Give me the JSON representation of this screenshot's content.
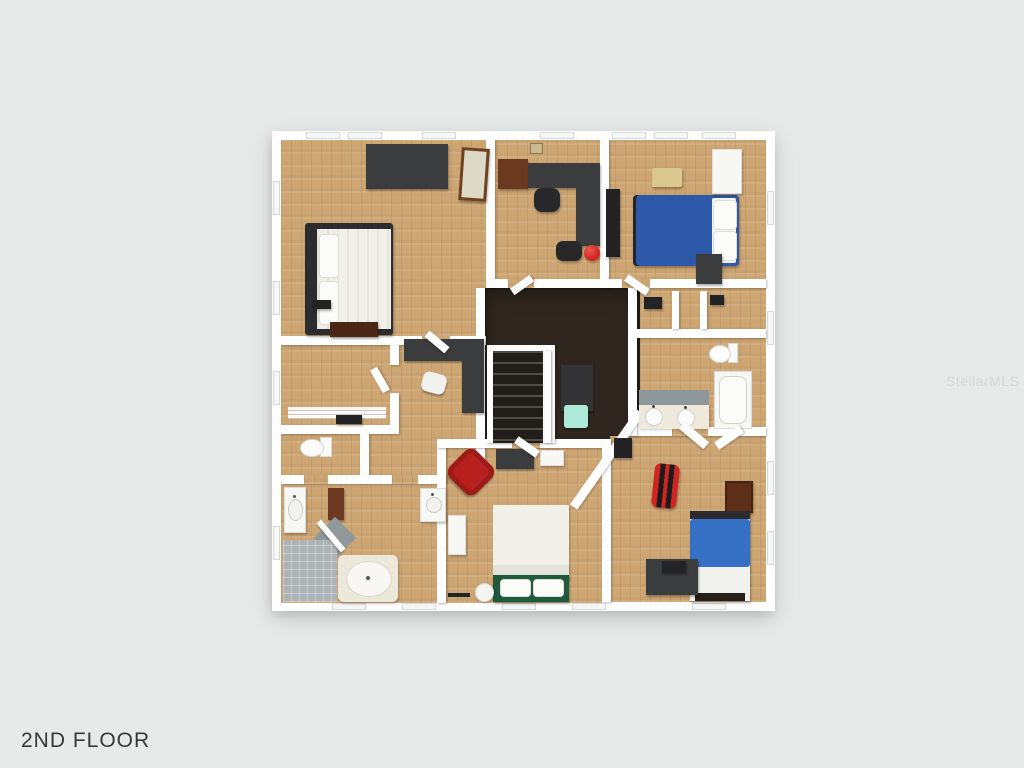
{
  "label": {
    "title": "2ND FLOOR"
  },
  "watermark": {
    "text": "StellarMLS"
  },
  "colors": {
    "bg": "#e8eaea",
    "wall": "#fefefe",
    "wood": "#cda673",
    "carpet": "#2f271f",
    "tile-gray": "#aeb4b6",
    "mat-gray": "#8f989a",
    "counter-cream": "#efe9dc",
    "bed-blue": "#2e59a8",
    "bed-blue-bright": "#3570c4",
    "linen-white": "#f0efe8",
    "chair-red": "#b7201d",
    "ball-red": "#cf2621",
    "gamer-red": "#d02420",
    "headboard-green": "#1e5a3b",
    "bench-tan": "#dbc890",
    "table-teal": "#aeead8",
    "furniture-dark": "#3b3c3e",
    "furniture-brown": "#6b3a20",
    "title": "#36383a",
    "watermark": "#d2d5d5"
  }
}
